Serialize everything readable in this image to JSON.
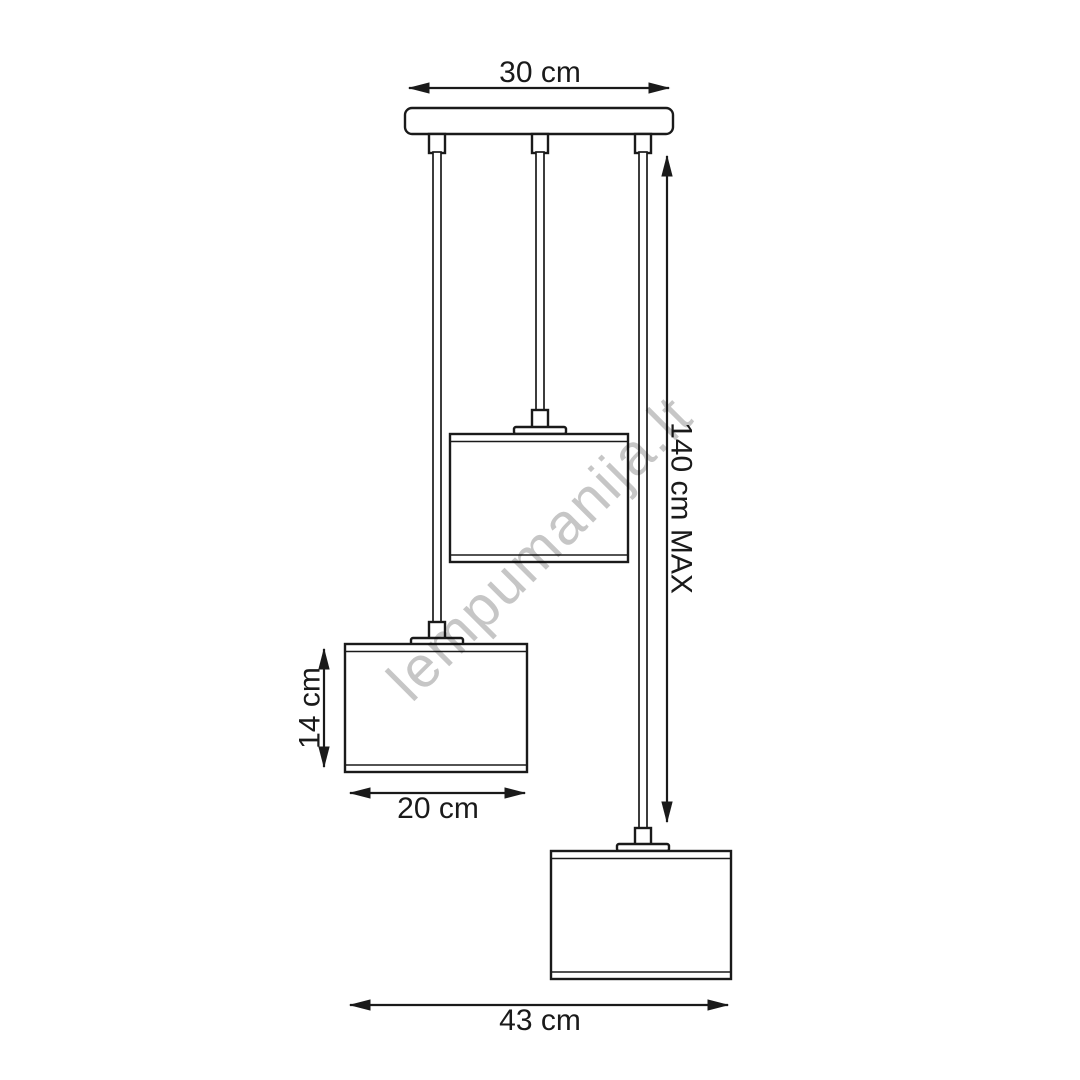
{
  "diagram": {
    "watermark": "lempumanija.lt",
    "dimensions": {
      "canopy_width": "30 cm",
      "max_drop": "140 cm MAX",
      "shade_height": "14 cm",
      "shade_width": "20 cm",
      "overall_width": "43 cm"
    },
    "colors": {
      "line": "#1a1a1a",
      "watermark": "#c6c6c6",
      "background": "#ffffff"
    }
  }
}
